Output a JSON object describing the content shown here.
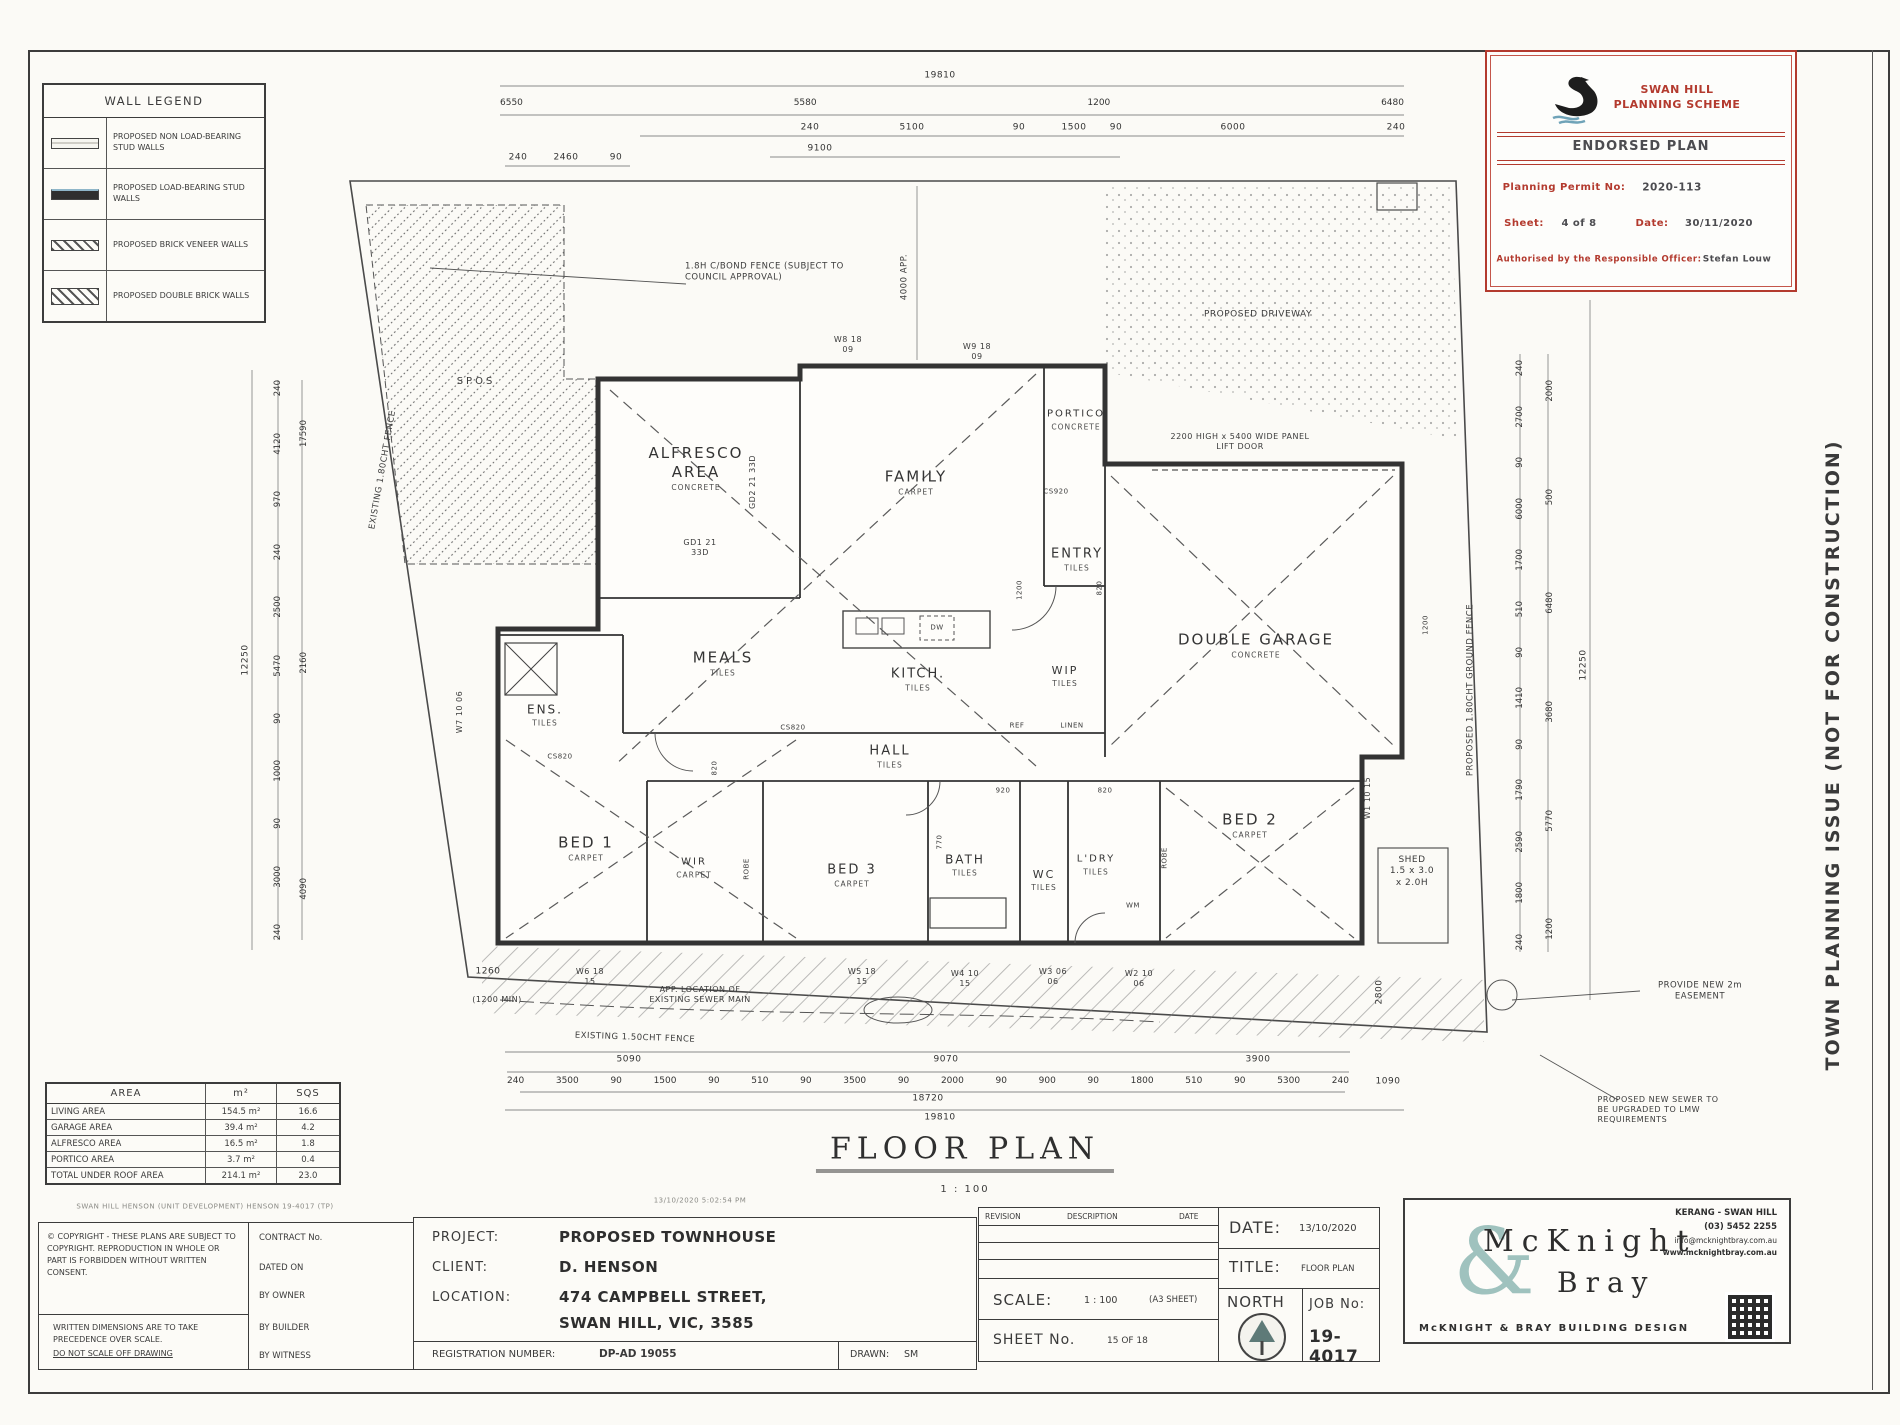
{
  "page": {
    "side_note": "TOWN PLANNING ISSUE (NOT FOR CONSTRUCTION)",
    "file_ref": "SWAN HILL HENSON (UNIT DEVELOPMENT) HENSON 19-4017 (TP)",
    "print_stamp": "13/10/2020 5:02:54 PM"
  },
  "wall_legend": {
    "title": "WALL LEGEND",
    "items": [
      "PROPOSED NON LOAD-BEARING STUD WALLS",
      "PROPOSED LOAD-BEARING STUD WALLS",
      "PROPOSED BRICK VENEER WALLS",
      "PROPOSED DOUBLE BRICK WALLS"
    ]
  },
  "stamp": {
    "scheme_line1": "SWAN HILL",
    "scheme_line2": "PLANNING SCHEME",
    "endorsed": "ENDORSED PLAN",
    "permit_label": "Planning Permit No:",
    "permit_value": "2020-113",
    "sheet_label": "Sheet:",
    "sheet_value": "4  of  8",
    "date_label": "Date:",
    "date_value": "30/11/2020",
    "auth_label": "Authorised by the Responsible Officer:",
    "auth_value": "Stefan Louw"
  },
  "plan": {
    "title": "FLOOR PLAN",
    "scale_note": "1 : 100",
    "rooms": {
      "alfresco": {
        "name": "ALFRESCO AREA",
        "finish": "CONCRETE"
      },
      "family": {
        "name": "FAMILY",
        "finish": "CARPET"
      },
      "portico": {
        "name": "PORTICO",
        "finish": "CONCRETE"
      },
      "entry": {
        "name": "ENTRY",
        "finish": "TILES"
      },
      "meals": {
        "name": "MEALS",
        "finish": "TILES"
      },
      "kitchen": {
        "name": "KITCH.",
        "finish": "TILES"
      },
      "wip": {
        "name": "WIP",
        "finish": "TILES"
      },
      "garage": {
        "name": "DOUBLE GARAGE",
        "finish": "CONCRETE"
      },
      "ens": {
        "name": "ENS.",
        "finish": "TILES"
      },
      "hall": {
        "name": "HALL",
        "finish": "TILES"
      },
      "bed1": {
        "name": "BED 1",
        "finish": "CARPET"
      },
      "wir": {
        "name": "WIR",
        "finish": "CARPET"
      },
      "bed3": {
        "name": "BED 3",
        "finish": "CARPET"
      },
      "bath": {
        "name": "BATH",
        "finish": "TILES"
      },
      "wc": {
        "name": "WC",
        "finish": "TILES"
      },
      "ldry": {
        "name": "L'DRY",
        "finish": "TILES"
      },
      "bed2": {
        "name": "BED 2",
        "finish": "CARPET"
      }
    },
    "shed": {
      "line1": "SHED",
      "line2": "1.5 x 3.0",
      "line3": "x 2.0H"
    },
    "annotations": {
      "spos": "SPOS",
      "fence_note": "1.8H C/BOND FENCE (SUBJECT TO COUNCIL APPROVAL)",
      "driveway": "PROPOSED DRIVEWAY",
      "panel_door": "2200 HIGH x 5400 WIDE PANEL LIFT DOOR",
      "fence_left": "EXISTING 1.80CHT FENCE",
      "fence_right": "PROPOSED 1.80CHT GROUND FENCE",
      "fence_bottom": "EXISTING 1.50CHT FENCE",
      "sewer_main": "APP. LOCATION OF EXISTING SEWER MAIN",
      "easement": "PROVIDE NEW 2m EASEMENT",
      "sewer_upgrade": "PROPOSED NEW SEWER TO BE UPGRADED TO LMW REQUIREMENTS",
      "approx_4000": "4000 APP."
    },
    "tags": {
      "w8": "W8 18 09",
      "w9": "W9 18 09",
      "w7": "W7 10 06",
      "w6": "W6 18 15",
      "w5": "W5 18 15",
      "w4": "W4 10 15",
      "w3": "W3 06 06",
      "w2": "W2 10 06",
      "w1": "W1 10 15",
      "gd1": "GD1 21 33D",
      "gd2": "GD2 21 33D",
      "cs820": "CS820",
      "cs920": "CS920",
      "d820": "820",
      "d770": "770",
      "d920": "920",
      "d1200": "1200",
      "dw": "DW",
      "ref": "REF",
      "linen": "LINEN",
      "robe": "ROBE",
      "wm": "WM"
    }
  },
  "dims": {
    "top1": "19810",
    "top2": [
      "6550",
      "5580",
      "1200",
      "6480"
    ],
    "top3": [
      "240",
      "5100",
      "90",
      "1500",
      "90",
      "6000",
      "240"
    ],
    "top4": "9100",
    "top5": [
      "240",
      "2460",
      "90"
    ],
    "left1": [
      "240",
      "4120",
      "970",
      "240",
      "2500",
      "5470",
      "90",
      "1000",
      "90",
      "3000",
      "240"
    ],
    "left2": [
      "17590",
      "2160",
      "4090"
    ],
    "left3": "12250",
    "right1": [
      "240",
      "2700",
      "90",
      "6000",
      "1700",
      "510",
      "90",
      "1410",
      "90",
      "1790",
      "2590",
      "1800",
      "240"
    ],
    "right2": [
      "2000",
      "500",
      "6480",
      "3680",
      "5770",
      "1200"
    ],
    "right3": "12250",
    "bottom1": [
      "5090",
      "9070",
      "3900"
    ],
    "bottom2": [
      "240",
      "3500",
      "90",
      "1500",
      "90",
      "510",
      "90",
      "3500",
      "90",
      "2000",
      "90",
      "900",
      "90",
      "1800",
      "510",
      "90",
      "5300",
      "240"
    ],
    "bottom3": "18720",
    "bottom4": "19810",
    "misc": [
      "1260",
      "(1200 MIN)",
      "2800",
      "1090"
    ]
  },
  "area_table": {
    "headers": [
      "AREA",
      "m²",
      "SQS"
    ],
    "rows": [
      [
        "LIVING AREA",
        "154.5 m²",
        "16.6"
      ],
      [
        "GARAGE AREA",
        "39.4 m²",
        "4.2"
      ],
      [
        "ALFRESCO AREA",
        "16.5 m²",
        "1.8"
      ],
      [
        "PORTICO AREA",
        "3.7 m²",
        "0.4"
      ],
      [
        "TOTAL UNDER ROOF AREA",
        "214.1 m²",
        "23.0"
      ]
    ]
  },
  "title_block": {
    "copyright": "© COPYRIGHT - THESE PLANS ARE SUBJECT TO COPYRIGHT. REPRODUCTION IN WHOLE OR PART IS FORBIDDEN WITHOUT WRITTEN CONSENT.",
    "dims_note1": "WRITTEN DIMENSIONS ARE TO TAKE PRECEDENCE OVER SCALE.",
    "dims_note2": "DO NOT SCALE OFF DRAWING",
    "contract_label": "CONTRACT No.",
    "dated_label": "DATED ON",
    "by_owner": "BY OWNER",
    "by_builder": "BY BUILDER",
    "by_witness": "BY WITNESS",
    "project_label": "PROJECT:",
    "project": "PROPOSED TOWNHOUSE",
    "client_label": "CLIENT:",
    "client": "D. HENSON",
    "location_label": "LOCATION:",
    "location1": "474 CAMPBELL STREET,",
    "location2": "SWAN HILL, VIC, 3585",
    "registration_label": "REGISTRATION NUMBER:",
    "registration": "DP-AD 19055",
    "drawn_label": "DRAWN:",
    "drawn": "SM",
    "rev_col1": "REVISION",
    "rev_col2": "DESCRIPTION",
    "rev_col3": "DATE",
    "scale_label": "SCALE:",
    "scale": "1 : 100",
    "scale_sheet": "(A3 SHEET)",
    "sheet_label": "SHEET No.",
    "sheet": "15 OF 18",
    "date_label": "DATE:",
    "date": "13/10/2020",
    "title_label": "TITLE:",
    "title": "FLOOR PLAN",
    "north_label": "NORTH",
    "job_label": "JOB No:",
    "job": "19-4017"
  },
  "branding": {
    "name_top": "McKnight",
    "amp": "&",
    "name_bottom": "Bray",
    "tagline": "McKNIGHT & BRAY BUILDING DESIGN",
    "region": "KERANG - SWAN HILL",
    "phone": "(03) 5452 2255",
    "email": "info@mcknightbray.com.au",
    "web": "www.mcknightbray.com.au"
  },
  "colors": {
    "stamp_red": "#b33a2e",
    "accent_teal": "#8fb8b4",
    "line": "#3c3c3c"
  }
}
